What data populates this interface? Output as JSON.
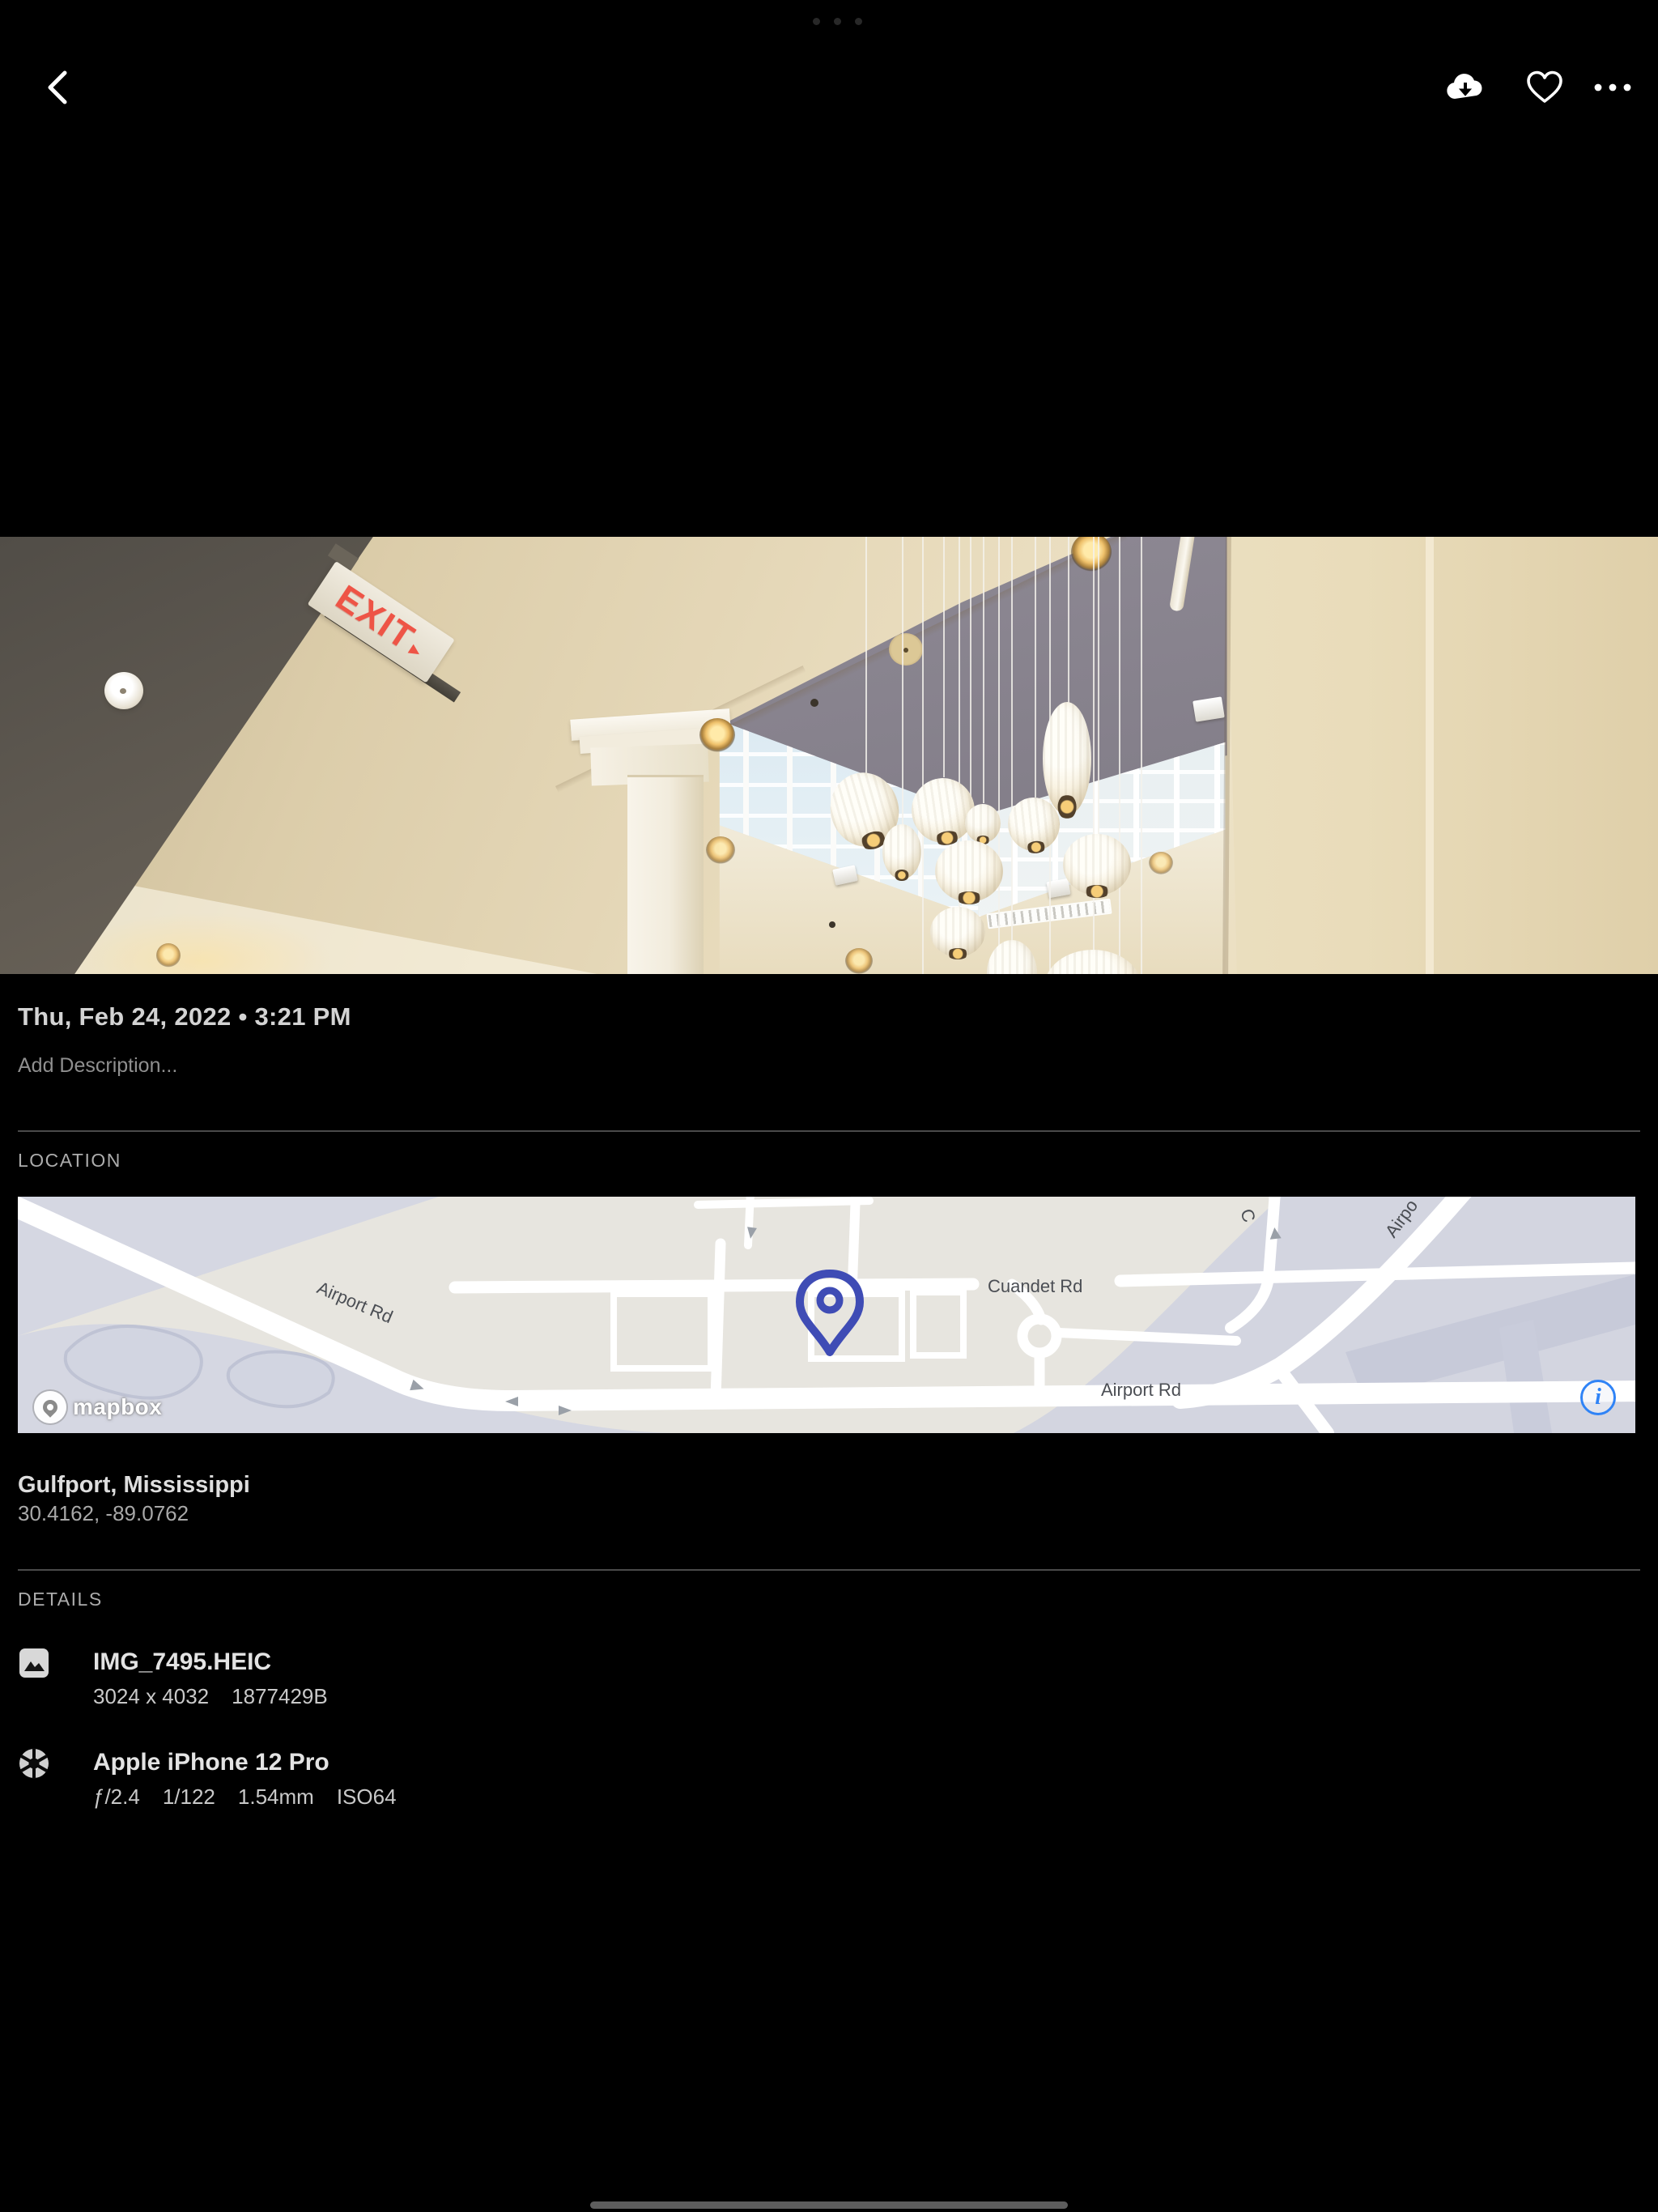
{
  "chrome": {
    "multitask_indicator": "...",
    "toolbar": {
      "back_icon": "back-chevron",
      "download_icon": "cloud-download",
      "favorite_icon": "heart-outline",
      "more_icon": "ellipsis"
    }
  },
  "photo": {
    "exit_sign": {
      "text": "EXIT",
      "arrow": "▸"
    }
  },
  "meta": {
    "date": "Thu, Feb 24, 2022 • 3:21 PM",
    "description_placeholder": "Add Description..."
  },
  "location": {
    "header": "LOCATION",
    "place": "Gulfport, Mississippi",
    "coordinates": "30.4162, -89.0762",
    "map": {
      "label_airport_diag": "Airport Rd",
      "label_cuandet": "Cuandet Rd",
      "label_airport_bottom": "Airport Rd",
      "label_airport_curve": "Airpo",
      "label_c_road": "C",
      "attribution": "mapbox",
      "info_glyph": "i",
      "pin_color": "#3f4cb5",
      "info_color": "#2f83f6"
    }
  },
  "details": {
    "header": "DETAILS",
    "file": {
      "name": "IMG_7495.HEIC",
      "dimensions": "3024 x 4032",
      "size": "1877429B"
    },
    "camera": {
      "name": "Apple iPhone 12 Pro",
      "aperture": "ƒ/2.4",
      "shutter": "1/122",
      "focal_length": "1.54mm",
      "iso": "ISO64"
    }
  },
  "colors": {
    "background": "#000000",
    "primary_text": "#d3d3d3",
    "secondary_text": "#8f8f8f",
    "divider": "#4a4a4a"
  }
}
